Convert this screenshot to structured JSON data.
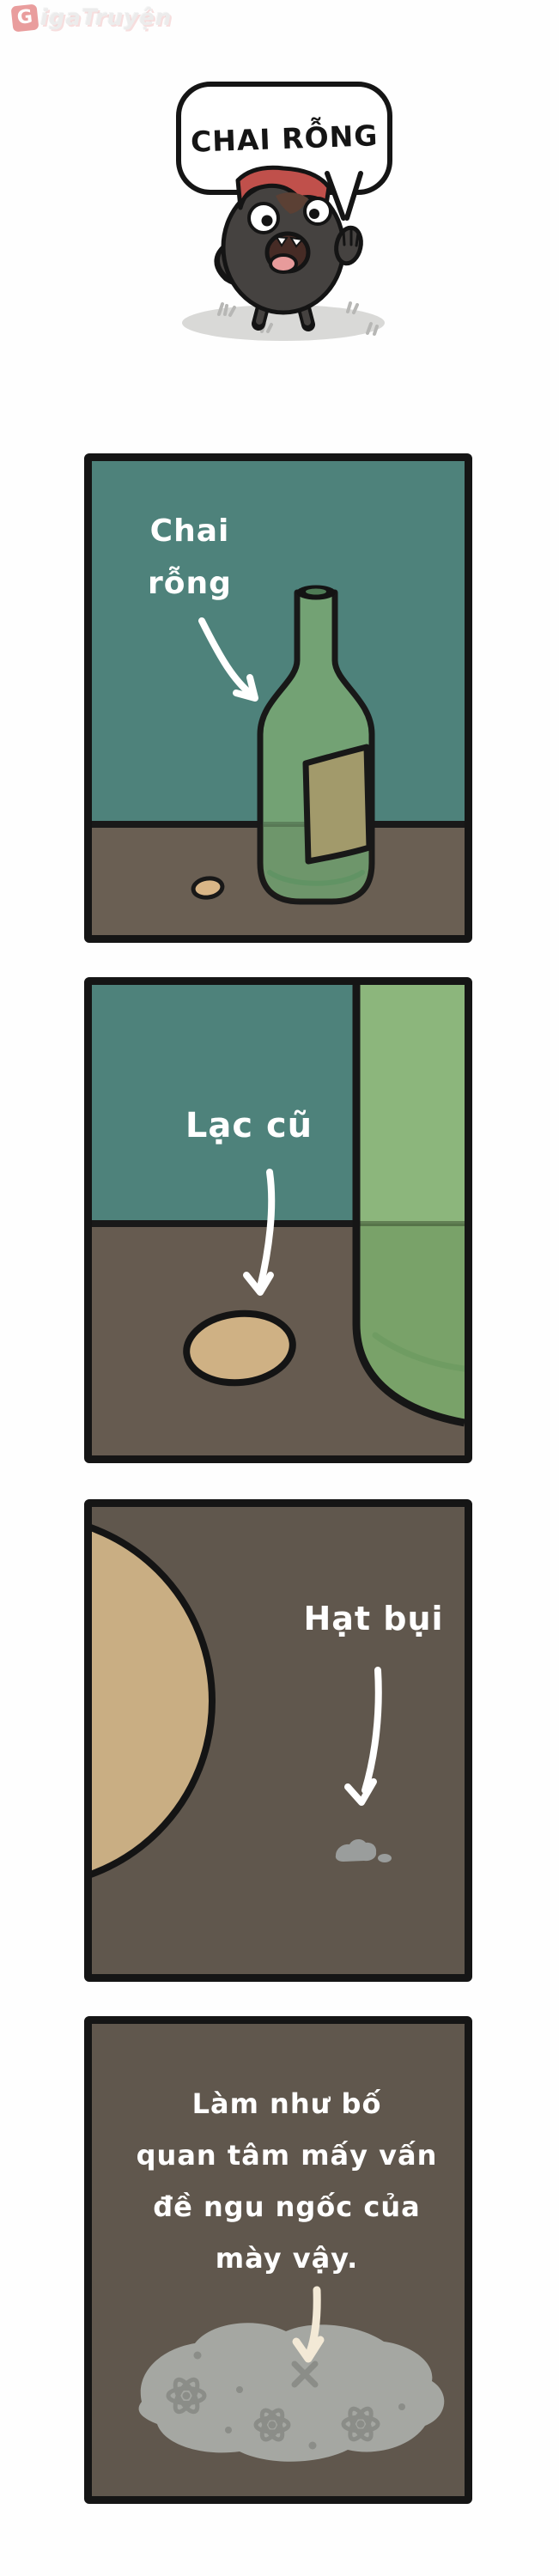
{
  "watermark": {
    "logo_letter": "G",
    "brand_text": "igaTruyện"
  },
  "speech_bubble": {
    "text": "CHAI RỖNG"
  },
  "panels": [
    {
      "name": "panel-1",
      "subject": "empty green bottle on floor",
      "caption_lines": [
        "Chai",
        "rỗng"
      ]
    },
    {
      "name": "panel-2",
      "subject": "old peanut beside bottle base",
      "caption_lines": [
        "Lạc cũ"
      ]
    },
    {
      "name": "panel-3",
      "subject": "dust speck next to giant peanut",
      "caption_lines": [
        "Hạt bụi"
      ]
    },
    {
      "name": "panel-4",
      "subject": "dust particle close-up with atoms",
      "caption_lines": [
        "Làm như bố",
        "quan tâm mấy vấn",
        "đề ngu ngốc của",
        "mày vậy."
      ]
    }
  ],
  "colors": {
    "wall_teal": "#4e827b",
    "floor_brown": "#6a5f53",
    "dark_ground": "#60574d",
    "bottle_green": "#73a274",
    "bottle_light_green": "#8cb67c",
    "label_olive": "#a29a6b",
    "peanut_tan": "#c9ae83",
    "dust_gray": "#a5a7a2",
    "atom_gray": "#8b8d88",
    "cap_red": "#c0504b",
    "character_gray": "#454240",
    "outline_black": "#151515",
    "arrow_white": "#ffffff",
    "arrow_cream": "#f3e9d6"
  }
}
